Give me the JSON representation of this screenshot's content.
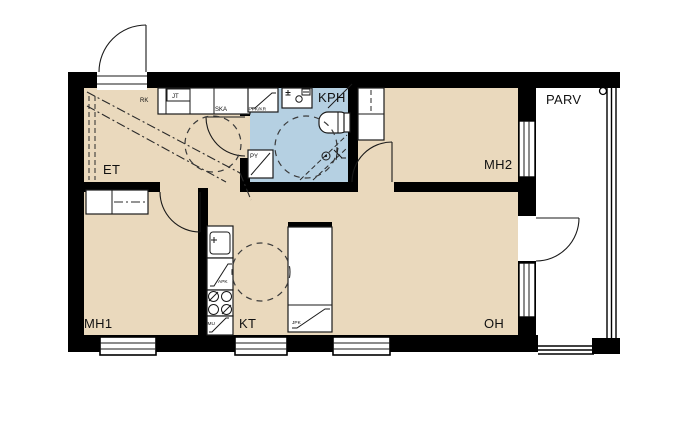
{
  "floor_plan": {
    "rooms": {
      "et": "ET",
      "kph": "KPH",
      "mh2": "MH2",
      "mh1": "MH1",
      "kt": "KT",
      "oh": "OH",
      "parv": "PARV"
    },
    "fixtures": {
      "rk": "RK",
      "jt": "JT",
      "ska": "SKA",
      "ppk_kr": "PPK/KR",
      "py": "PY",
      "apk": "APK",
      "mu": "MU",
      "jpk": "JPK"
    },
    "colors": {
      "floor": "#ead9bd",
      "wet_room": "#b5d0e2",
      "wall": "#000000",
      "line": "#1a1a1a",
      "background": "#ffffff"
    }
  }
}
